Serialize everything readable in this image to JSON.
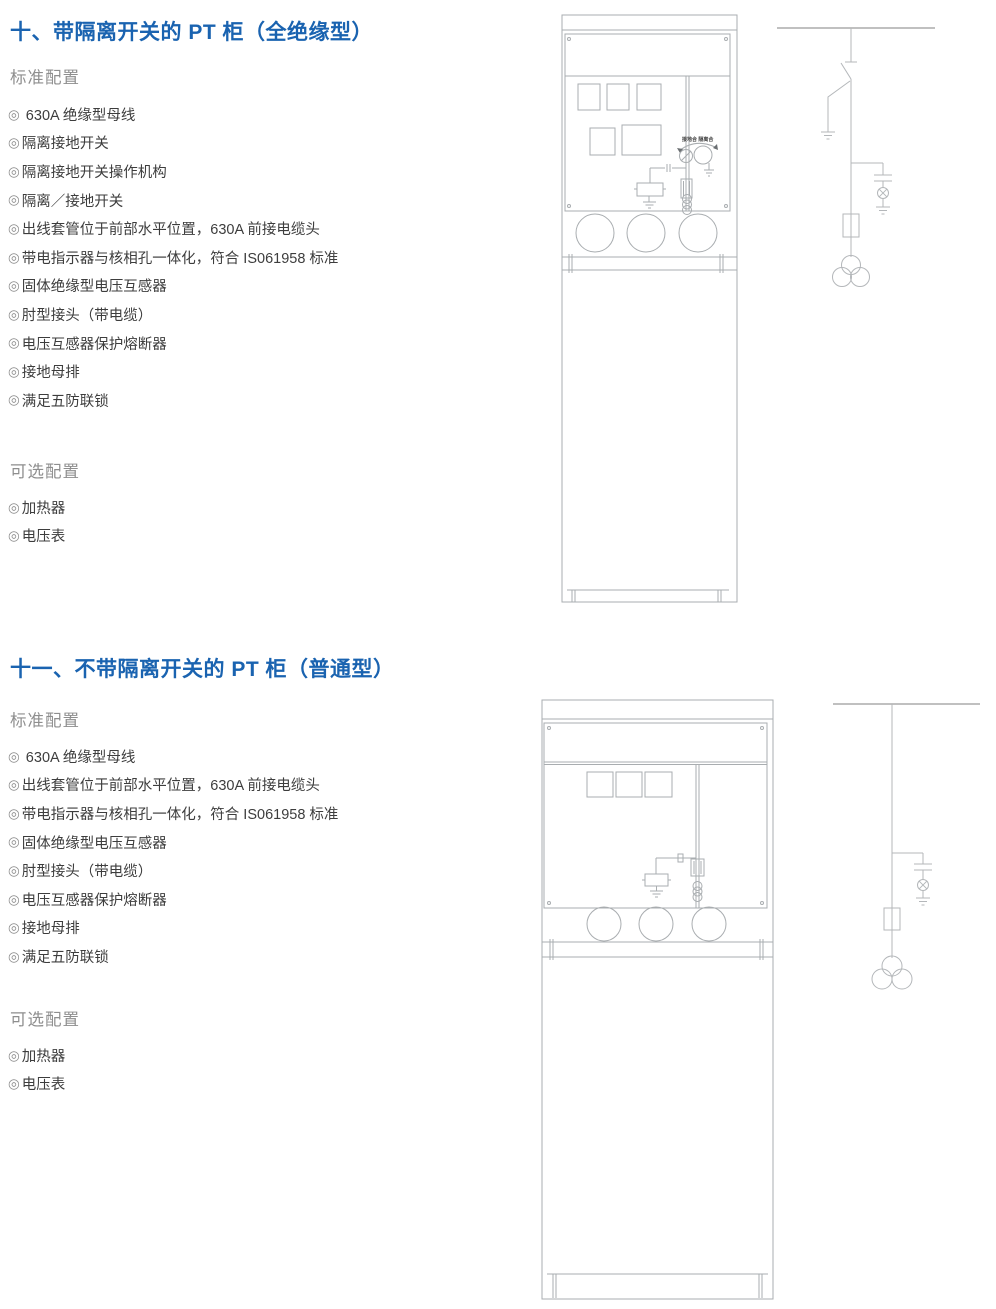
{
  "page": {
    "bullet_glyph": "◎"
  },
  "colors": {
    "title_blue": "#1A63B0",
    "heading_gray": "#8E8E8E",
    "body_text": "#3D3D3D",
    "drawing_line_gray": "#A9ADB0"
  },
  "sections": [
    {
      "title": "十、带隔离开关的 PT 柜（全绝缘型）",
      "standard_heading": "标准配置",
      "standard_items": [
        " 630A 绝缘型母线",
        "隔离接地开关",
        "隔离接地开关操作机构",
        "隔离／接地开关",
        "出线套管位于前部水平位置，630A 前接电缆头",
        "带电指示器与核相孔一体化，符合 IS061958 标准",
        "固体绝缘型电压互感器",
        "肘型接头（带电缆）",
        "电压互感器保护熔断器",
        "接地母排",
        "满足五防联锁"
      ],
      "optional_heading": "可选配置",
      "optional_items": [
        "加热器",
        "电压表"
      ],
      "drawing": {
        "switch_label": "接地合 隔离合"
      }
    },
    {
      "title": "十一、不带隔离开关的 PT 柜（普通型）",
      "standard_heading": "标准配置",
      "standard_items": [
        " 630A 绝缘型母线",
        "出线套管位于前部水平位置，630A 前接电缆头",
        "带电指示器与核相孔一体化，符合 IS061958 标准",
        "固体绝缘型电压互感器",
        "肘型接头（带电缆）",
        "电压互感器保护熔断器",
        "接地母排",
        "满足五防联锁"
      ],
      "optional_heading": "可选配置",
      "optional_items": [
        "加热器",
        "电压表"
      ]
    }
  ]
}
